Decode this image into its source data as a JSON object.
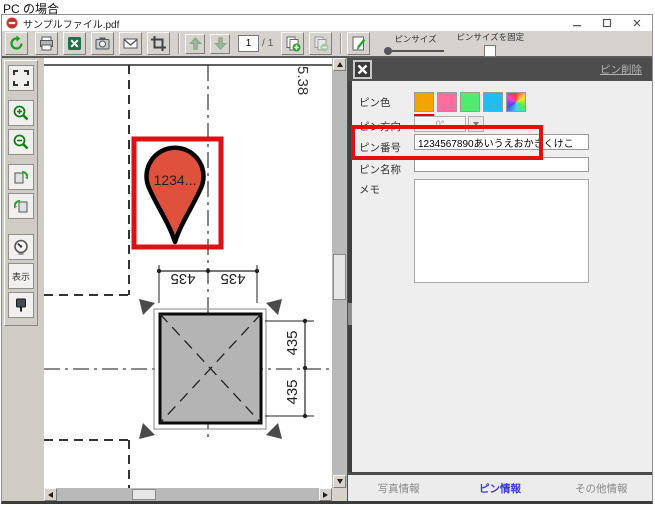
{
  "page_label": "PC の場合",
  "window": {
    "title": "サンプルファイル.pdf"
  },
  "toolbar": {
    "page_current": "1",
    "page_separator": "/",
    "page_total": "1",
    "pin_size_label": "ピンサイズ",
    "pin_size_fix_label": "ピンサイズを固定"
  },
  "sidebar": {
    "display_label": "表示"
  },
  "drawing": {
    "pin_label": "1234...",
    "elevation_label": "5.38",
    "dim_top_left": "435",
    "dim_top_right": "435",
    "dim_right_top": "435",
    "dim_right_bottom": "435"
  },
  "panel": {
    "delete_link": "ピン削除",
    "color_label": "ピン色",
    "direction_label": "ピン方向",
    "direction_value": "0°",
    "number_label": "ピン番号",
    "number_value": "1234567890あいうえおかきくけこ",
    "name_label": "ピン名称",
    "name_value": "",
    "memo_label": "メモ",
    "memo_value": "",
    "swatches": [
      "#f5a300",
      "#ff6e9e",
      "#4dec72",
      "#1fbdf2"
    ],
    "tabs": [
      {
        "label": "写真情報",
        "active": false
      },
      {
        "label": "ピン情報",
        "active": true
      },
      {
        "label": "その他情報",
        "active": false
      }
    ]
  },
  "colors": {
    "annotation": "#dd1111",
    "pin_fill": "#e0513d",
    "active_tab": "#3a3ad0"
  }
}
